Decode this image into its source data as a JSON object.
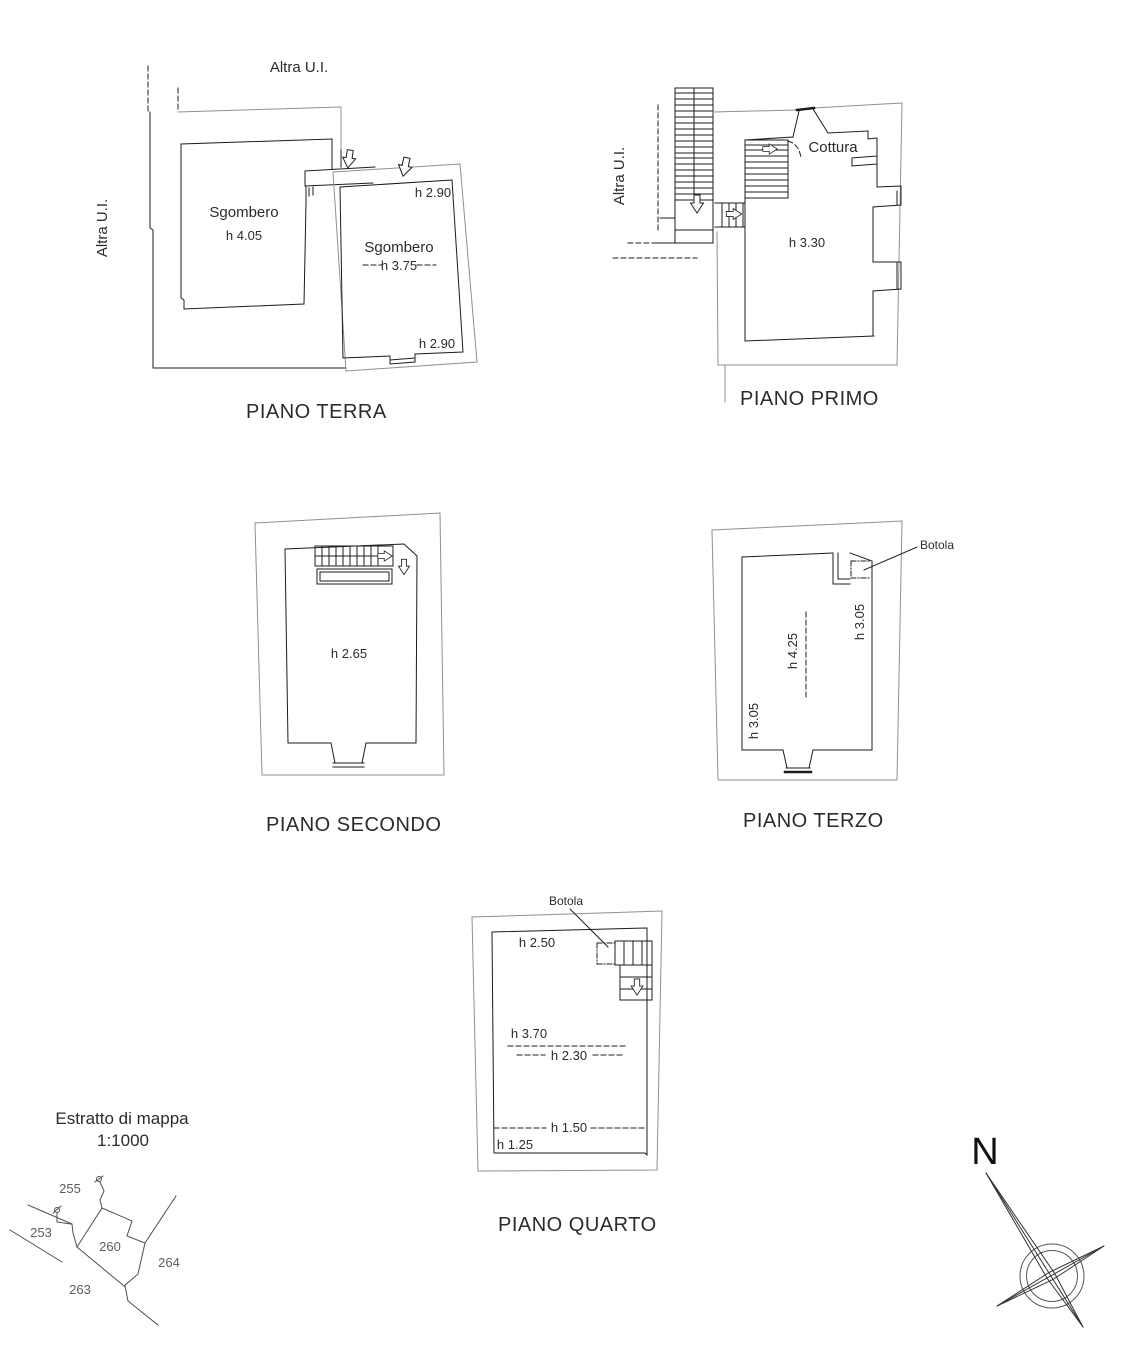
{
  "colors": {
    "wall": "#1c1c1c",
    "boundary": "#909090",
    "ink": "#2b2b2b",
    "map_line": "#4f4f4f",
    "map_text": "#5d5d5d"
  },
  "plans": {
    "terra": {
      "caption": "PIANO TERRA",
      "altra_ui_top": "Altra U.I.",
      "altra_ui_left": "Altra U.I.",
      "room_left_name": "Sgombero",
      "room_left_height": "h 4.05",
      "room_right_name": "Sgombero",
      "room_right_height": "h 3.75",
      "height_top_right": "h 2.90",
      "height_bottom_right": "h 2.90"
    },
    "primo": {
      "caption": "PIANO PRIMO",
      "altra_ui": "Altra U.I.",
      "kitchen_label": "Cottura",
      "room_height": "h 3.30"
    },
    "secondo": {
      "caption": "PIANO SECONDO",
      "room_height": "h 2.65"
    },
    "terzo": {
      "caption": "PIANO TERZO",
      "trapdoor_label": "Botola",
      "height_center": "h 4.25",
      "height_right": "h 3.05",
      "height_left": "h 3.05"
    },
    "quarto": {
      "caption": "PIANO QUARTO",
      "trapdoor_label": "Botola",
      "height_top": "h 2.50",
      "height_mid_upper": "h 3.70",
      "height_mid_lower": "h 2.30",
      "height_low": "h 1.50",
      "height_bottom": "h 1.25"
    }
  },
  "map_extract": {
    "title": "Estratto di mappa",
    "scale": "1:1000",
    "parcels": {
      "p255": "255",
      "p253": "253",
      "p260": "260",
      "p264": "264",
      "p263": "263"
    }
  },
  "compass": {
    "north": "N"
  }
}
